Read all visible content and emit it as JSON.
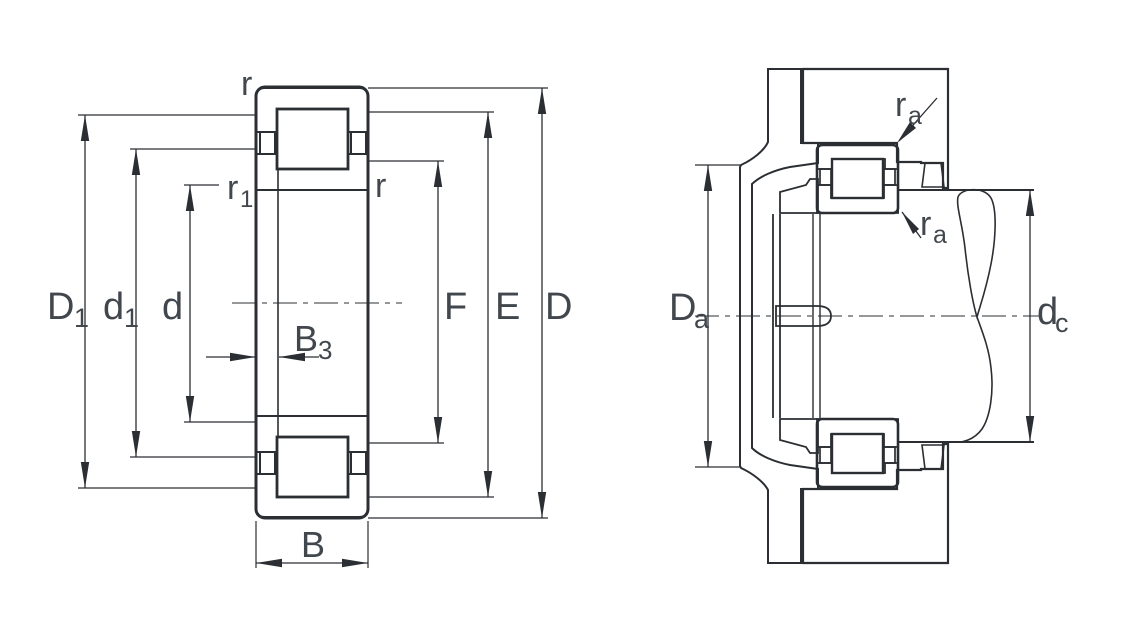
{
  "drawing": {
    "type": "bearing-technical-drawing",
    "views": {
      "left_view_name": "cylindrical roller bearing cross-section with boundary dimensions",
      "right_view_name": "mounting example with abutment dimensions"
    }
  },
  "colors": {
    "line": "#2b2f33",
    "text": "#41474d",
    "background": "#ffffff"
  },
  "left_view": {
    "labels": {
      "r_top": "r",
      "r_inner": "r",
      "r1": {
        "main": "r",
        "sub": "1"
      },
      "D1": {
        "main": "D",
        "sub": "1"
      },
      "d1": {
        "main": "d",
        "sub": "1"
      },
      "d": "d",
      "B3": {
        "main": "B",
        "sub": "3"
      },
      "B": "B",
      "F": "F",
      "E": "E",
      "D": "D"
    }
  },
  "right_view": {
    "labels": {
      "ra_top": {
        "main": "r",
        "sub": "a"
      },
      "ra_bottom": {
        "main": "r",
        "sub": "a"
      },
      "Da": {
        "main": "D",
        "sub": "a"
      },
      "dc": {
        "main": "d",
        "sub": "c"
      }
    }
  }
}
